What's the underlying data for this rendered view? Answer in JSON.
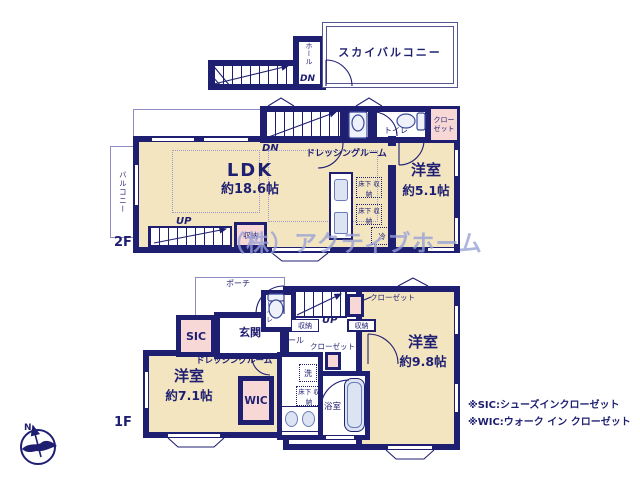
{
  "colors": {
    "wall": "#1f1f72",
    "cream": "#f3e5c0",
    "pink": "#f7d8d6",
    "fix": "#dce4f4",
    "wm": "#98a2d8"
  },
  "roof": {
    "hall": "ホール",
    "dn": "DN",
    "sky_balcony": "スカイバルコニー"
  },
  "f2": {
    "label": "2F",
    "balcony": "バルコニー",
    "dn": "DN",
    "dressing": "ドレッシングルーム",
    "toilet": "トイレ",
    "closet": "クロー\nゼット",
    "ldk": "LDK",
    "ldk_size": "約18.6帖",
    "underfloor": "床下\n収納",
    "fridge": "冷",
    "room": "洋室",
    "room_size": "約5.1帖",
    "up": "UP",
    "storage": "収納"
  },
  "f1": {
    "label": "1F",
    "porch": "ポーチ",
    "sic": "SIC",
    "genkan": "玄関",
    "toilet": "トイレ",
    "hall": "ホール",
    "storage_a": "収納",
    "up": "UP",
    "storage_b": "収納",
    "closet_a": "クローゼット",
    "closet_b": "クローゼット",
    "room1": "洋室",
    "room1_size": "約9.8帖",
    "dressing": "ドレッシングルーム",
    "room2": "洋室",
    "room2_size": "約7.1帖",
    "wic": "WIC",
    "wash": "洗",
    "underfloor": "床下\n収納",
    "bath": "浴室"
  },
  "notes": {
    "line1": "※SIC:シューズインクローゼット",
    "line2": "※WIC:ウォーク イン クローゼット"
  },
  "watermark": "（株）アクティブホーム",
  "compass": {
    "n": "N"
  }
}
